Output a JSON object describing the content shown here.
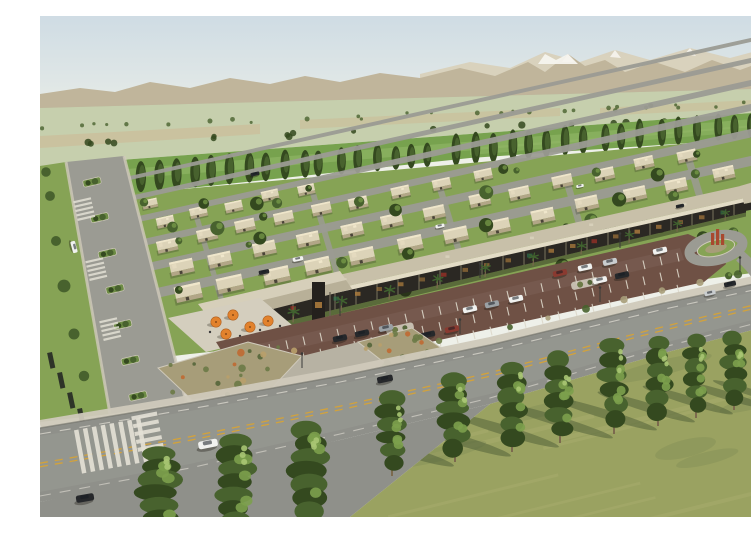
{
  "meta": {
    "type": "architectural-aerial-rendering",
    "caption": "Aerial rendering of a master-planned desert community: flat-roofed villas with lawns, a shaded retail strip with palm trees and cafe umbrellas, clay-paved parking, a wide arterial road, poplar windbreaks, farmland and snow-capped mountains on the horizon.",
    "width_px": 751,
    "height_px": 501
  },
  "palette": {
    "skyTop": "#cfdce4",
    "skyMid": "#e0e7e6",
    "horizon": "#eef0e9",
    "mFar": "#d8cfb8",
    "mNear": "#c0b59b",
    "snow": "#f6f4ee",
    "foothill": "#a7ac92",
    "hazeField": "#c6cfad",
    "fieldTan": "#ccbc98",
    "fieldGreen": "#77a24e",
    "fieldGreenLt": "#93b868",
    "treeDark": "#34491f",
    "treeMid": "#48622e",
    "treeLt": "#7ca04c",
    "treeHi": "#a9c573",
    "lawn": "#86a355",
    "lawnDark": "#6d8c45",
    "street": "#9b9b93",
    "walk": "#cfc9ba",
    "wall": "#e6dcc0",
    "wallSide": "#b2a687",
    "roofTop": "#dcd3b8",
    "roofHi": "#efe6cb",
    "doorDk": "#4a4438",
    "stripRoof": "#c8c0a9",
    "stripEdge": "#e3dcc6",
    "colonnade": "#2b2823",
    "glow": "#a8793c",
    "palmG": "#40622f",
    "trunk": "#7c6a4e",
    "terrace": "#d4cebe",
    "umbrella": "#e2822d",
    "parking": "#6f5145",
    "stripe": "#ddd8ca",
    "bedBase": "#a79d79",
    "shrub1": "#6c7a46",
    "shrub2": "#55663a",
    "shrub3": "#b9a06a",
    "shrubOr": "#c06a32",
    "road": "#8f908a",
    "yellow": "#d2a23c",
    "white": "#e3e0d5",
    "kerb": "#6e6e65",
    "grass": "#9aa261",
    "grassLt": "#b4b477",
    "grassDk": "#74824e",
    "shadow": "#4c5c35",
    "carWhite": "#f0f1ef",
    "carDark": "#26282b",
    "carGrey": "#9ba1a5",
    "carRed": "#8a3a30",
    "carSilver": "#c9cdcf",
    "signRed": "#b03226",
    "signGreen": "#2f7d52",
    "sculpture": "#a8492f",
    "hedge": "#2e3428",
    "pylon": "#24211d"
  },
  "scene": {
    "sky": {
      "label": "hazy pale-blue sky"
    },
    "mountains": {
      "label": "tan mountain range with snow-capped peaks",
      "snow_peaks": 4
    },
    "farmland": {
      "label": "patchwork farm fields with orchard rows",
      "tan_strips": 3
    },
    "windbreaks": {
      "label": "poplar windbreak rows along the fields",
      "rows": 2,
      "trees_left_row": 22,
      "trees_right_row": 19
    },
    "village": {
      "label": "single-storey flat-roof villas with lawns",
      "house_rows": 7,
      "street_rows": 6,
      "yard_trees": 60
    },
    "boulevard": {
      "label": "planted-median boulevard on the left",
      "median_islands": 7
    },
    "retail_strip": {
      "label": "retail strip with dark shaded colonnade",
      "palm_trees": 11,
      "entrance_canopy": true,
      "sign_pylon": true,
      "storefront_lights": 24
    },
    "cafe_terrace": {
      "label": "cafe terrace at the strip's end",
      "umbrellas": 5
    },
    "parking_lot": {
      "label": "clay-paved parking lot with angled bays",
      "bay_rows": 3,
      "parked_cars": 16
    },
    "roundabout": {
      "label": "landscaped traffic island with red sculpture"
    },
    "main_road": {
      "label": "wide arterial road, double yellow centerline",
      "crosswalks": 2,
      "moving_cars": 5
    },
    "planting_beds": {
      "label": "xeriscape planting beds",
      "count": 2
    },
    "foreground": {
      "label": "dry meadow with a row of young poplars casting long shadows",
      "poplar_trees": 13
    }
  }
}
